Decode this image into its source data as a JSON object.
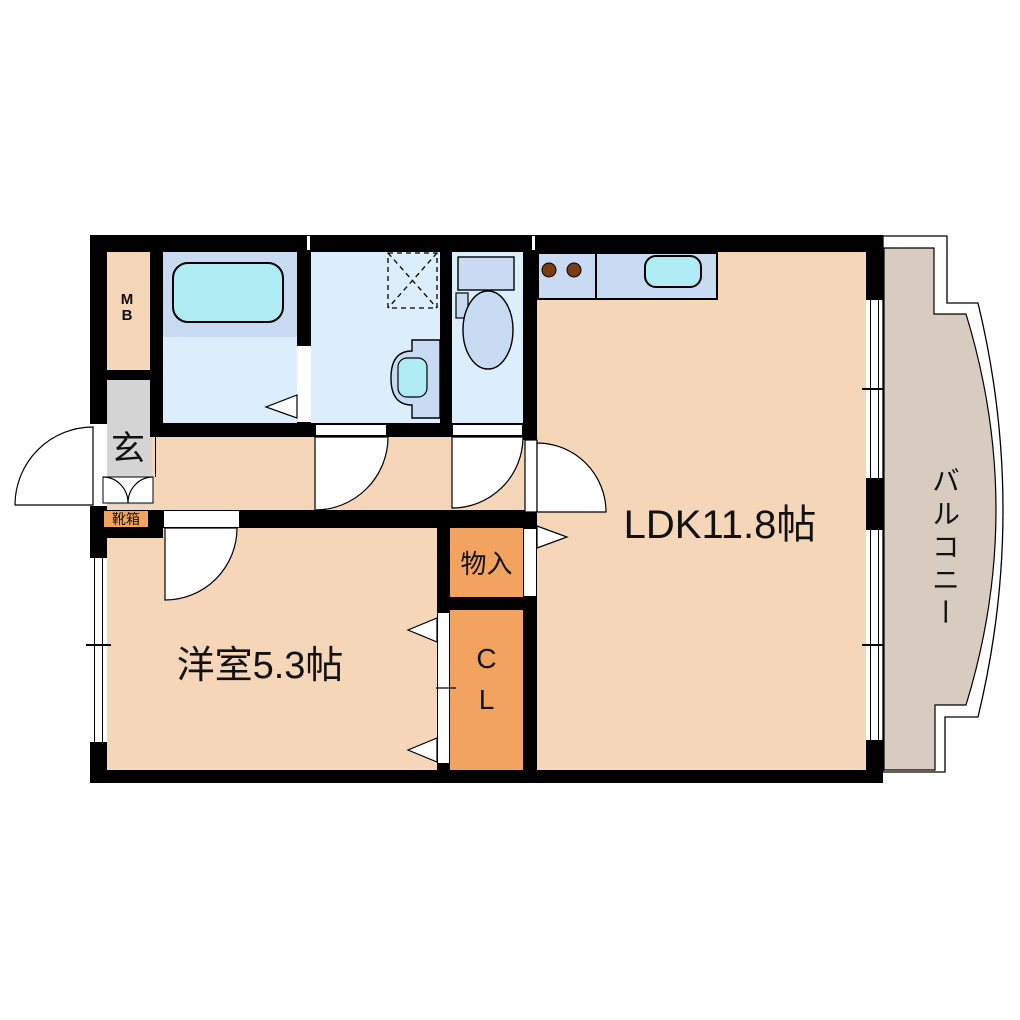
{
  "floorplan": {
    "title": "1LDK apartment floor plan",
    "labels": {
      "ldk": "LDK11.8帖",
      "western_room": "洋室5.3帖",
      "storage": "物入",
      "closet_line1": "C",
      "closet_line2": "L",
      "entrance": "玄",
      "shoe_box": "靴箱",
      "meter_box_line1": "M",
      "meter_box_line2": "B",
      "balcony": "バルコニー"
    },
    "colors": {
      "floor": "#f5d6b8",
      "balcony": "#d8cbc0",
      "wet_room": "#dcedfb",
      "wet_room_dark": "#c8dbf2",
      "fixture_cyan": "#b0ecf4",
      "closet_orange": "#f1a35f",
      "entrance_gray": "#d4d4d4",
      "wall": "#000000",
      "burner_brown": "#7b3c10"
    }
  }
}
